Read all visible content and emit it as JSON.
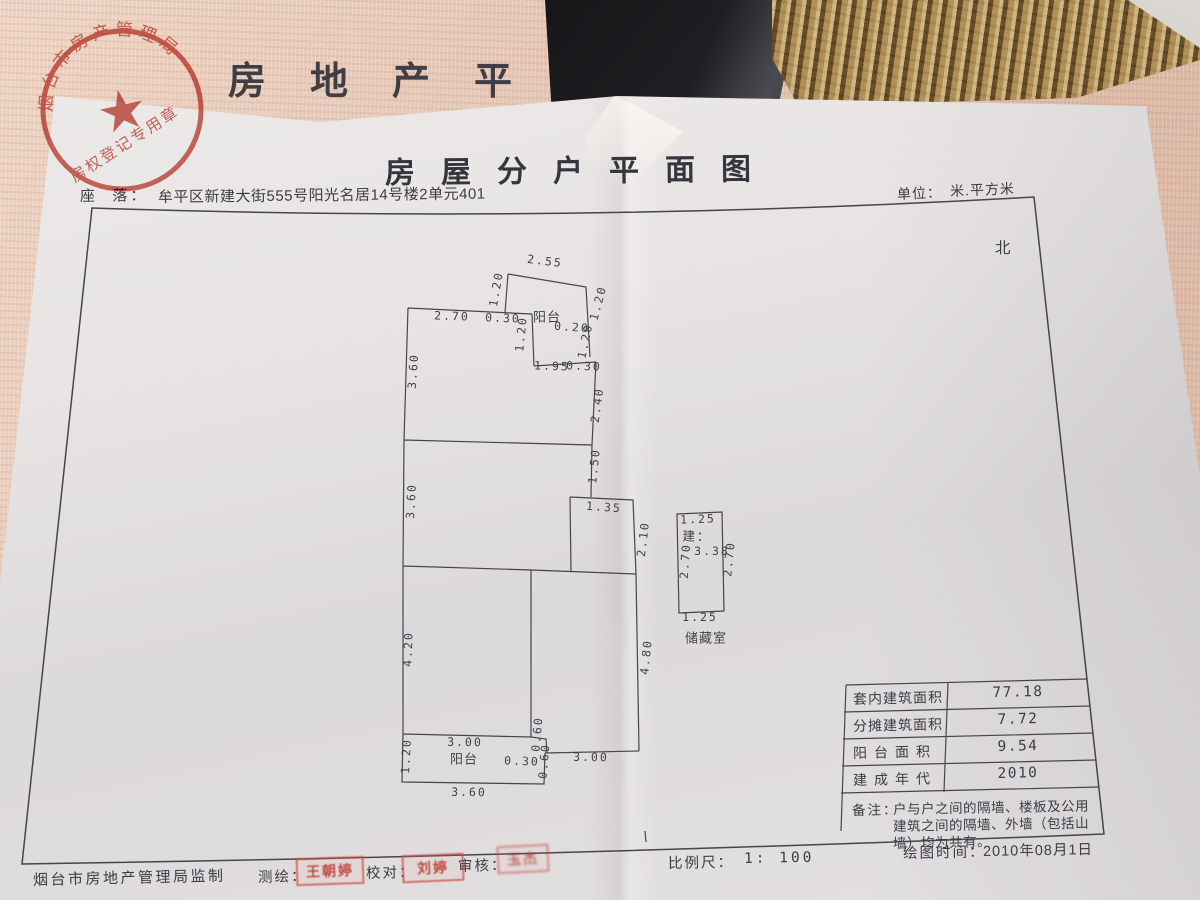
{
  "colors": {
    "seal_red": "#c6473c",
    "paper": "#e6e3e2",
    "cover_pink": "#e5c5b2",
    "line_ink": "#45454f",
    "gold": "#95784b"
  },
  "cover": {
    "partial_title": "房地产平面图",
    "seal_ring": "烟台市房产管理局",
    "seal_banner": "房权登记专用章",
    "seal_star": "★"
  },
  "document": {
    "title": "房屋分户平面图",
    "location_label": "座  落：",
    "location_value": "牟平区新建大街555号阳光名居14号楼2单元401",
    "unit_label": "单位：",
    "unit_value": "米.平方米",
    "north": "北"
  },
  "plan": {
    "labels": {
      "balcony_top": "阳台",
      "balcony_bottom": "阳台",
      "storage": "储藏室",
      "storage_build_label": "建：",
      "storage_area": "3.38"
    },
    "dims": [
      {
        "v": "2.55"
      },
      {
        "v": "1.20"
      },
      {
        "v": "1.20"
      },
      {
        "v": "2.70"
      },
      {
        "v": "0.30"
      },
      {
        "v": "0.20"
      },
      {
        "v": "1.20"
      },
      {
        "v": "1.20"
      },
      {
        "v": "1.95"
      },
      {
        "v": "0.30"
      },
      {
        "v": "3.60"
      },
      {
        "v": "2.40"
      },
      {
        "v": "3.60"
      },
      {
        "v": "1.50"
      },
      {
        "v": "1.35"
      },
      {
        "v": "2.10"
      },
      {
        "v": "4.20"
      },
      {
        "v": "4.80"
      },
      {
        "v": "3.00"
      },
      {
        "v": "0.60"
      },
      {
        "v": "1.20"
      },
      {
        "v": "0.30"
      },
      {
        "v": "0.60"
      },
      {
        "v": "3.00"
      },
      {
        "v": "3.60"
      },
      {
        "v": "1.25"
      },
      {
        "v": "2.70"
      },
      {
        "v": "2.70"
      },
      {
        "v": "1.25"
      }
    ]
  },
  "table": {
    "rows": [
      {
        "label": "套内建筑面积",
        "value": "77.18"
      },
      {
        "label": "分摊建筑面积",
        "value": "7.72"
      },
      {
        "label": "阳台面积",
        "value": "9.54"
      },
      {
        "label": "建成年代",
        "value": "2010"
      }
    ],
    "remark_label": "备注：",
    "remark_line1": "户与户之间的隔墙、楼板及公用",
    "remark_line2": "建筑之间的隔墙、外墙（包括山",
    "remark_line3": "墙）均为共有。"
  },
  "footer": {
    "issuer": "烟台市房地产管理局监制",
    "surveyor_label": "测绘：",
    "surveyor_stamp": "王朝婷",
    "checker_label": "校对：",
    "checker_stamp": "刘婷",
    "auditor_label": "审核：",
    "auditor_stamp": "玉杰",
    "scale_label": "比例尺：",
    "scale_value": "1: 100",
    "drawn_label": "绘图时间：",
    "drawn_value": "2010年08月1日"
  }
}
